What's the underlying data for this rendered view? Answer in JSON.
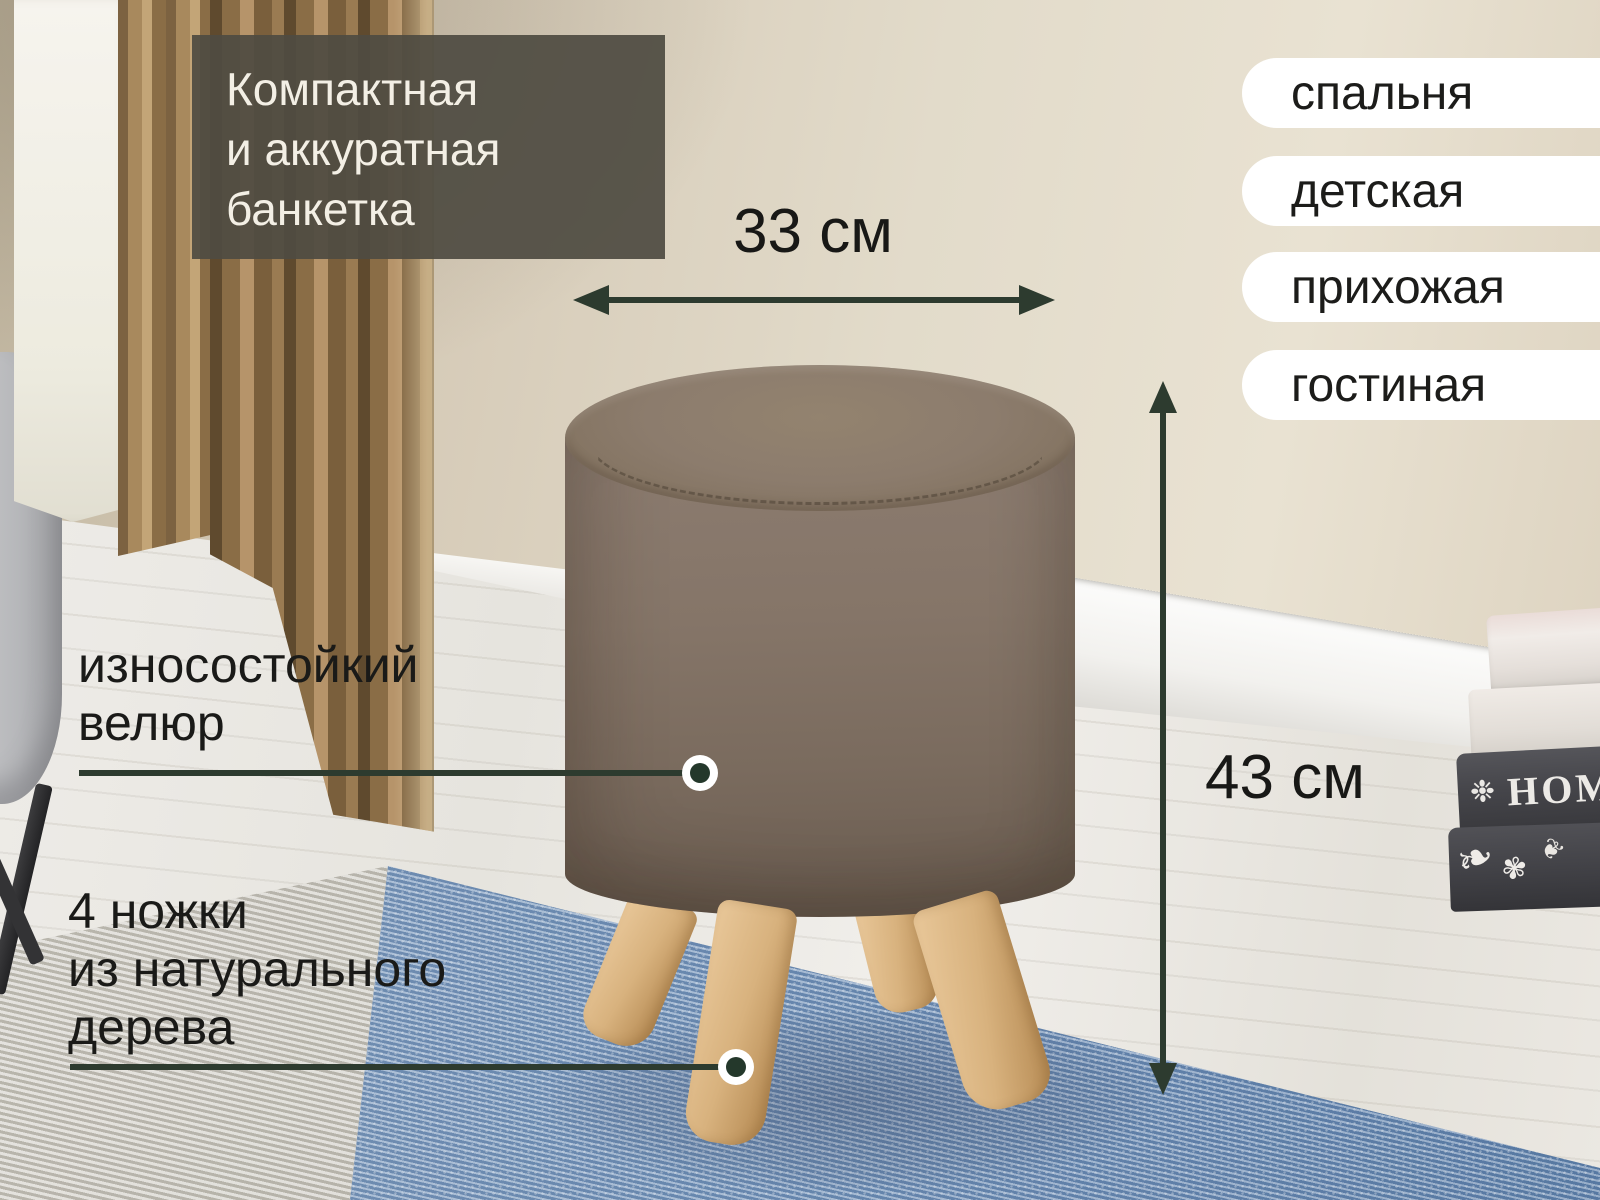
{
  "headline": {
    "text": "Компактная\nи аккуратная\nбанкетка"
  },
  "dimension_labels": {
    "width": "33 см",
    "height": "43 см"
  },
  "feature_callouts": [
    {
      "text": "износостойкий\nвелюр"
    },
    {
      "text": "4 ножки\nиз натурального\nдерева"
    }
  ],
  "room_tags": [
    {
      "label": "спальня"
    },
    {
      "label": "детская"
    },
    {
      "label": "прихожая"
    },
    {
      "label": "гостиная"
    }
  ],
  "scene": {
    "book_spine_title": "HOME"
  },
  "colors": {
    "accent_green": "#2d3b2f",
    "headline_bg": "#4f4b42",
    "headline_text": "#f3efe5",
    "label_text": "#1a1a18",
    "pill_bg": "#ffffff",
    "ottoman_fabric": "#7e6f63",
    "leg_wood": "#d8b27e",
    "rug_blue": "#7b99bd",
    "wall_beige": "#d6cbb8"
  }
}
